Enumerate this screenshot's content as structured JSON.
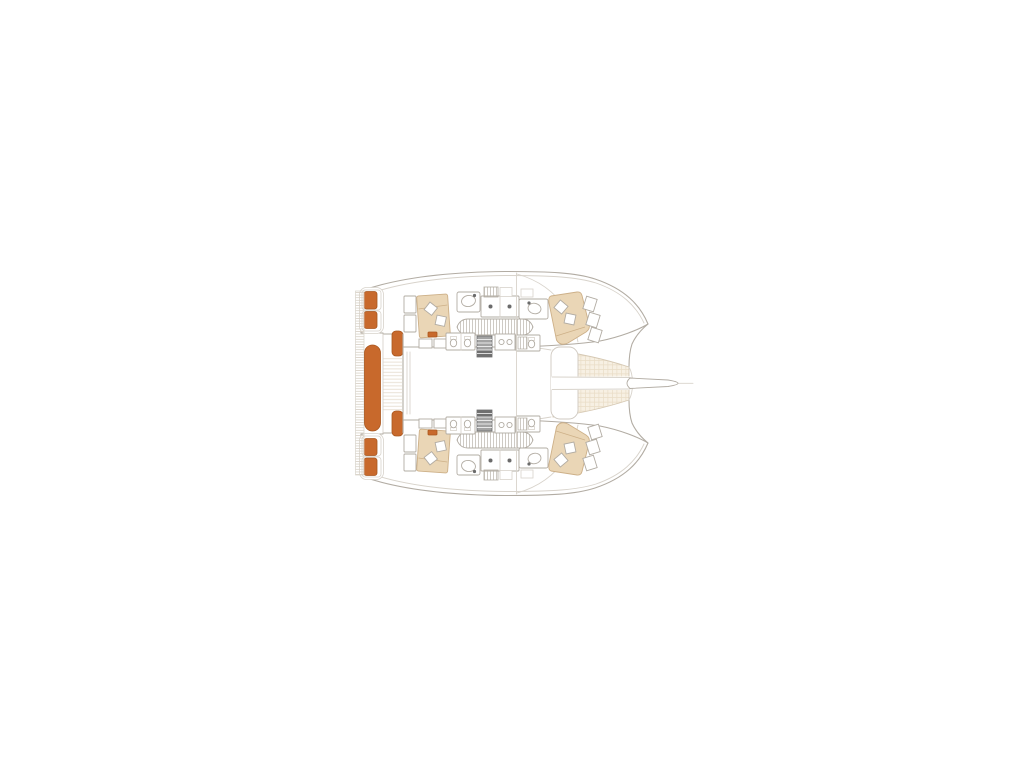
{
  "page": {
    "title": "Catamaran deck and interior floor plan",
    "background": "#ffffff"
  },
  "colors": {
    "accent_orange": "#c8692c",
    "accent_border": "#a9571f",
    "wood_tan": "#ead6b6",
    "wood_border": "#cdb088",
    "outline": "#b2aca3",
    "outline_light": "#d8d3cb",
    "trampoline_fill": "#f7f0e3",
    "trampoline_grid": "#e9dcc6",
    "stair_gray": "#a3a3a3",
    "stair_dark": "#707070",
    "background": "#ffffff"
  },
  "plan": {
    "vessel": "sailing catamaran",
    "view": "top-down plan, bow pointing right",
    "labels": {
      "floorplan": "Catamaran floor plan",
      "port_hull": "Port hull with cabins",
      "starboard_hull": "Starboard hull with cabins (mirrored)",
      "saloon": "Central saloon",
      "cockpit": "Aft cockpit",
      "cockpit_bench": "Aft cockpit bench cushion",
      "cockpit_seat": "Cockpit side seat cushion",
      "swim_platform": "Transom swim platform steps",
      "transom_steps": "Transom step cushions",
      "aft_cabin_bed": "Aft cabin double berth",
      "forward_cabin_bed": "Forward cabin double berth",
      "pillows": "Berth pillows",
      "galley_sink": "Sink with faucet",
      "stove": "Counter with burners",
      "hull_walkway": "Hull passageway",
      "head_wc": "Head / WC fixtures",
      "shower_panel": "Hatched shower / locker panel",
      "companionway_stairs": "Companionway stairs to hull",
      "trampoline": "Bow trampoline net",
      "forward_beam": "Forward crossbeam platform",
      "bowsprit": "Bowsprit",
      "mast_beam": "Mast beam line",
      "deck_hatches": "Foredeck hatches",
      "windshield": "Coachroof windshield line"
    }
  }
}
